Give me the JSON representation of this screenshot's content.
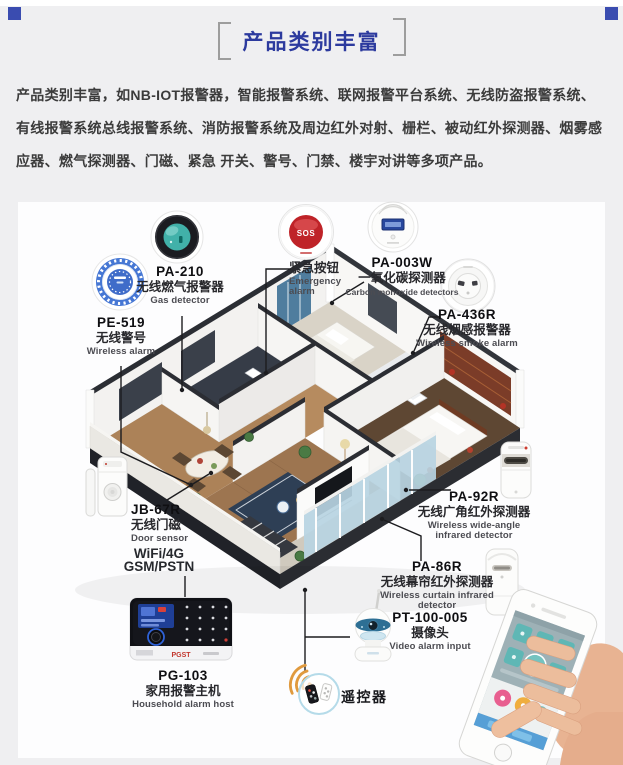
{
  "page": {
    "section_title": "产品类别丰富",
    "intro": "产品类别丰富，如NB-IOT报警器，智能报警系统、联网报警平台系统、无线防盗报警系统、有线报警系统总线报警系统、消防报警系统及周边红外对射、栅栏、被动红外探测器、烟雾感应器、燃气探测器、门磁、紧急 开关、警号、门禁、楼宇对讲等多项产品。"
  },
  "products": [
    {
      "model": "PE-519",
      "name_cn": "无线警号",
      "name_en": "Wireless alarm"
    },
    {
      "model": "PA-210",
      "name_cn": "无线燃气报警器",
      "name_en": "Gas detector"
    },
    {
      "model": "",
      "name_cn": "紧急按钮",
      "name_en": "Emergency alarm",
      "button_text": "SOS"
    },
    {
      "model": "PA-003W",
      "name_cn": "一氧化碳探测器",
      "name_en": "Carbon monoxide detectors"
    },
    {
      "model": "PA-436R",
      "name_cn": "无线烟感报警器",
      "name_en": "Wireless smoke alarm"
    },
    {
      "model": "JB-67R",
      "name_cn": "无线门磁",
      "name_en": "Door sensor"
    },
    {
      "model": "PA-92R",
      "name_cn": "无线广角红外探测器",
      "name_en": "Wireless wide-angle infrared detector"
    },
    {
      "model": "PA-86R",
      "name_cn": "无线幕帘红外探测器",
      "name_en": "Wireless curtain infrared detector"
    },
    {
      "model": "PT-100-005",
      "name_cn": "摄像头",
      "name_en": "Video alarm input"
    },
    {
      "model": "PG-103",
      "name_cn": "家用报警主机",
      "name_en": "Household alarm host"
    }
  ],
  "host": {
    "connectivity_line1": "WiFi/4G",
    "connectivity_line2": "GSM/PSTN",
    "brand": "PGST"
  },
  "remote": {
    "label": "遥控器"
  },
  "colors": {
    "accent_blue": "#3a4cb0",
    "title_blue": "#2c3a9e",
    "sos_red": "#bf2328",
    "wifi_orange": "#e09a3e",
    "glass_blue": "#b7d4e2"
  }
}
